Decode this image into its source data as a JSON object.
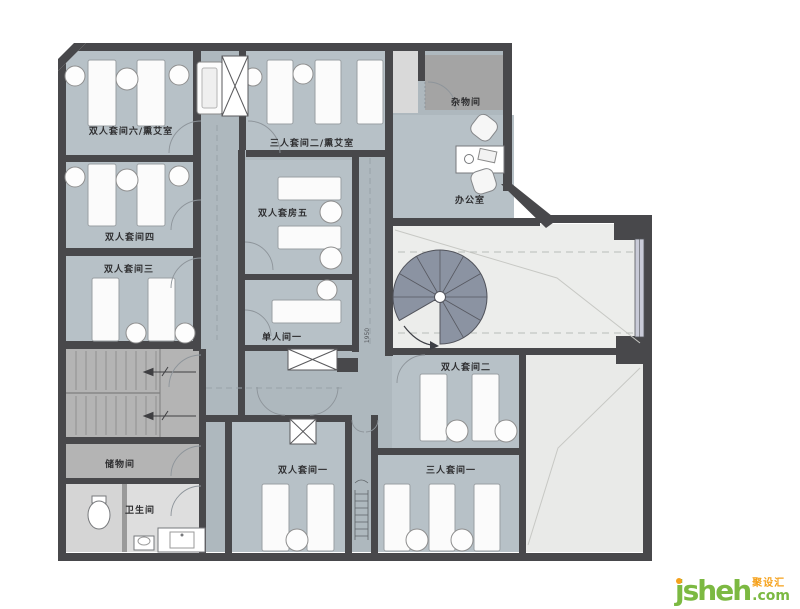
{
  "labels": {
    "suite6": "双人套间六/熏艾室",
    "suite2_3": "三人套间二/熏艾室",
    "utility": "杂物间",
    "office": "办公室",
    "suite5": "双人套房五",
    "suite4": "双人套间四",
    "suite3": "双人套间三",
    "single1": "单人间一",
    "suite2": "双人套间二",
    "storage": "储物间",
    "bath": "卫生间",
    "suite1": "双人套间一",
    "suite1_3": "三人套间一"
  },
  "dimensions": {
    "stair": "1950"
  },
  "logo": {
    "name": "jsheh",
    "tld": ".com",
    "badge": "聚设汇"
  },
  "colors": {
    "wall": "#48484b",
    "room_floor": "#b7c1c7",
    "corridor_floor": "#aeb8be",
    "void_floor": "#ecedeb",
    "utility_floor": "#a4a4a4",
    "logo_green": "#7cb942",
    "logo_orange": "#f5a11c"
  }
}
